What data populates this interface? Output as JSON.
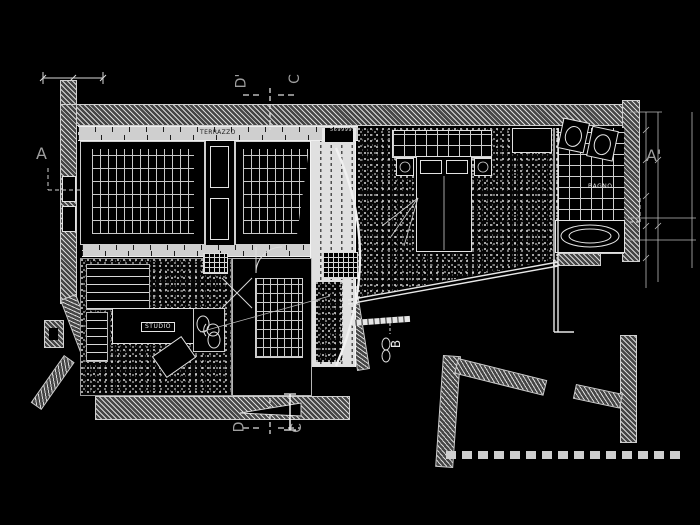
{
  "drawing": {
    "type": "cad-floor-plan",
    "background": "#000000",
    "labels": {
      "section_a_left": "A",
      "section_a_right": "A'",
      "section_d_top": "D'",
      "section_c_top": "C",
      "section_d_bottom": "D",
      "section_c_bottom": "C",
      "section_b": "B",
      "room_studio": "STUDIO",
      "room_bagno": "BAGNO",
      "terrace_strip": "TERRAZZO",
      "dim_number": "5699999"
    },
    "colors": {
      "line": "#e8e8e8",
      "hatch_light": "#d9d9d9",
      "hatch_dark": "#454545",
      "letter_gray": "#9f9f9f",
      "strip_gray": "#cfcfcf"
    }
  }
}
